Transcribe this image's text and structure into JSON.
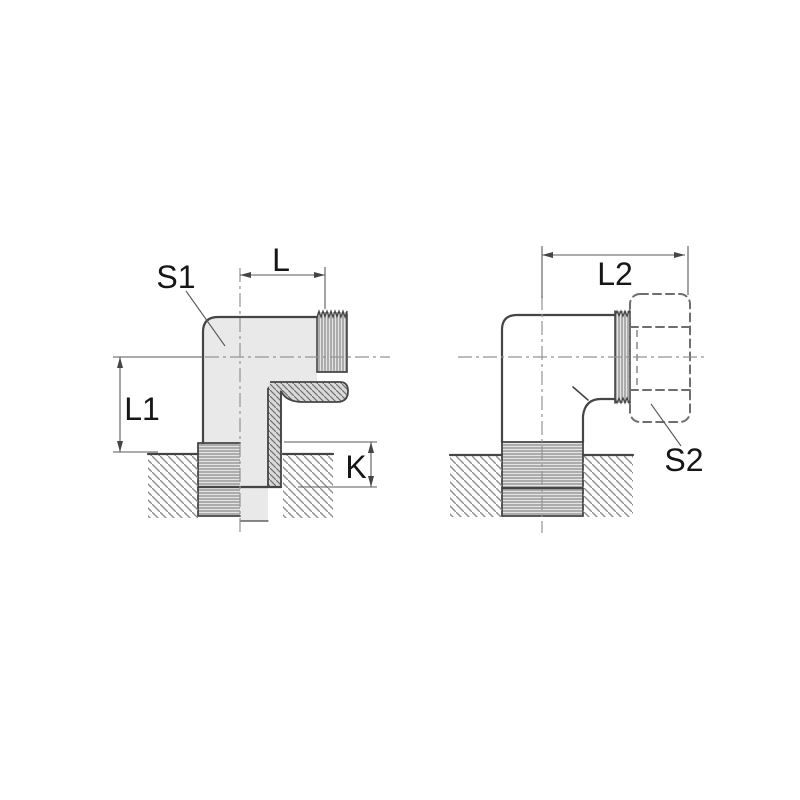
{
  "drawing": {
    "type": "technical-drawing-elbow-fitting",
    "views": {
      "left": {
        "description": "half-sectioned front view of male stud elbow",
        "dimensions": {
          "l": "L",
          "s1": "S1",
          "l1": "L1",
          "k": "K"
        }
      },
      "right": {
        "description": "side view of elbow with phantom nut",
        "dimensions": {
          "l2": "L2",
          "s2": "S2"
        }
      }
    },
    "colors": {
      "background": "#ffffff",
      "outline": "#454545",
      "body_fill": "#e9e9e9",
      "section_fill": "#d9d9d9",
      "thread_fill": "#e4e4e4",
      "hatch": "#8f8f8f",
      "centerline": "#949494",
      "dimension_line": "#5a5a5a",
      "phantom_line": "#6e6e6e",
      "text": "#161616"
    }
  }
}
